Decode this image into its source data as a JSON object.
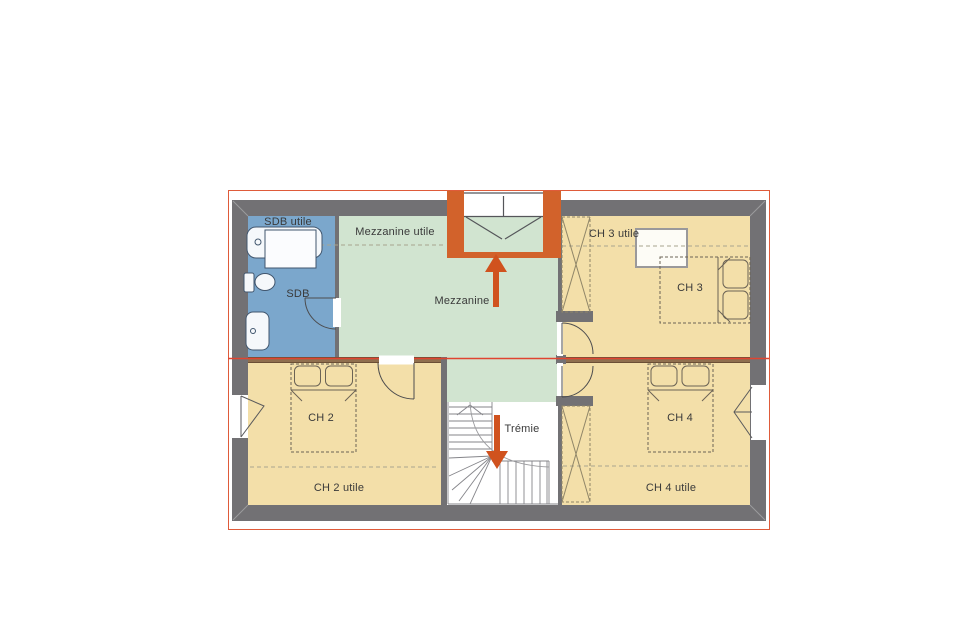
{
  "plan": {
    "type": "floor-plan-first-floor",
    "rooms": [
      {
        "key": "sdb",
        "label": "SDB",
        "area_label": "SDB utile",
        "fill": "#7ba7cc"
      },
      {
        "key": "mezzanine",
        "label": "Mezzanine",
        "area_label": "Mezzanine utile",
        "fill": "#d1e4d0"
      },
      {
        "key": "ch2",
        "label": "CH 2",
        "area_label": "CH 2 utile",
        "fill": "#f3dfa9"
      },
      {
        "key": "ch3",
        "label": "CH 3",
        "area_label": "CH 3 utile",
        "fill": "#f3dfa9"
      },
      {
        "key": "ch4",
        "label": "CH 4",
        "area_label": "CH 4 utile",
        "fill": "#f3dfa9"
      },
      {
        "key": "tremie",
        "label": "Trémie",
        "fill": "#ffffff"
      }
    ],
    "colors": {
      "wall": "#727174",
      "bathroom_blue": "#7ba7cc",
      "mezzanine_green": "#d1e4d0",
      "bedroom_tan": "#f3dfa9",
      "entry_frame_orange": "#d2622b",
      "arrow_orange": "#d0521e",
      "roof_outline": "#df5b3a",
      "level_line_red": "#e04430",
      "divider_wall_brown": "#8f6f4e",
      "background": "#ffffff"
    }
  }
}
